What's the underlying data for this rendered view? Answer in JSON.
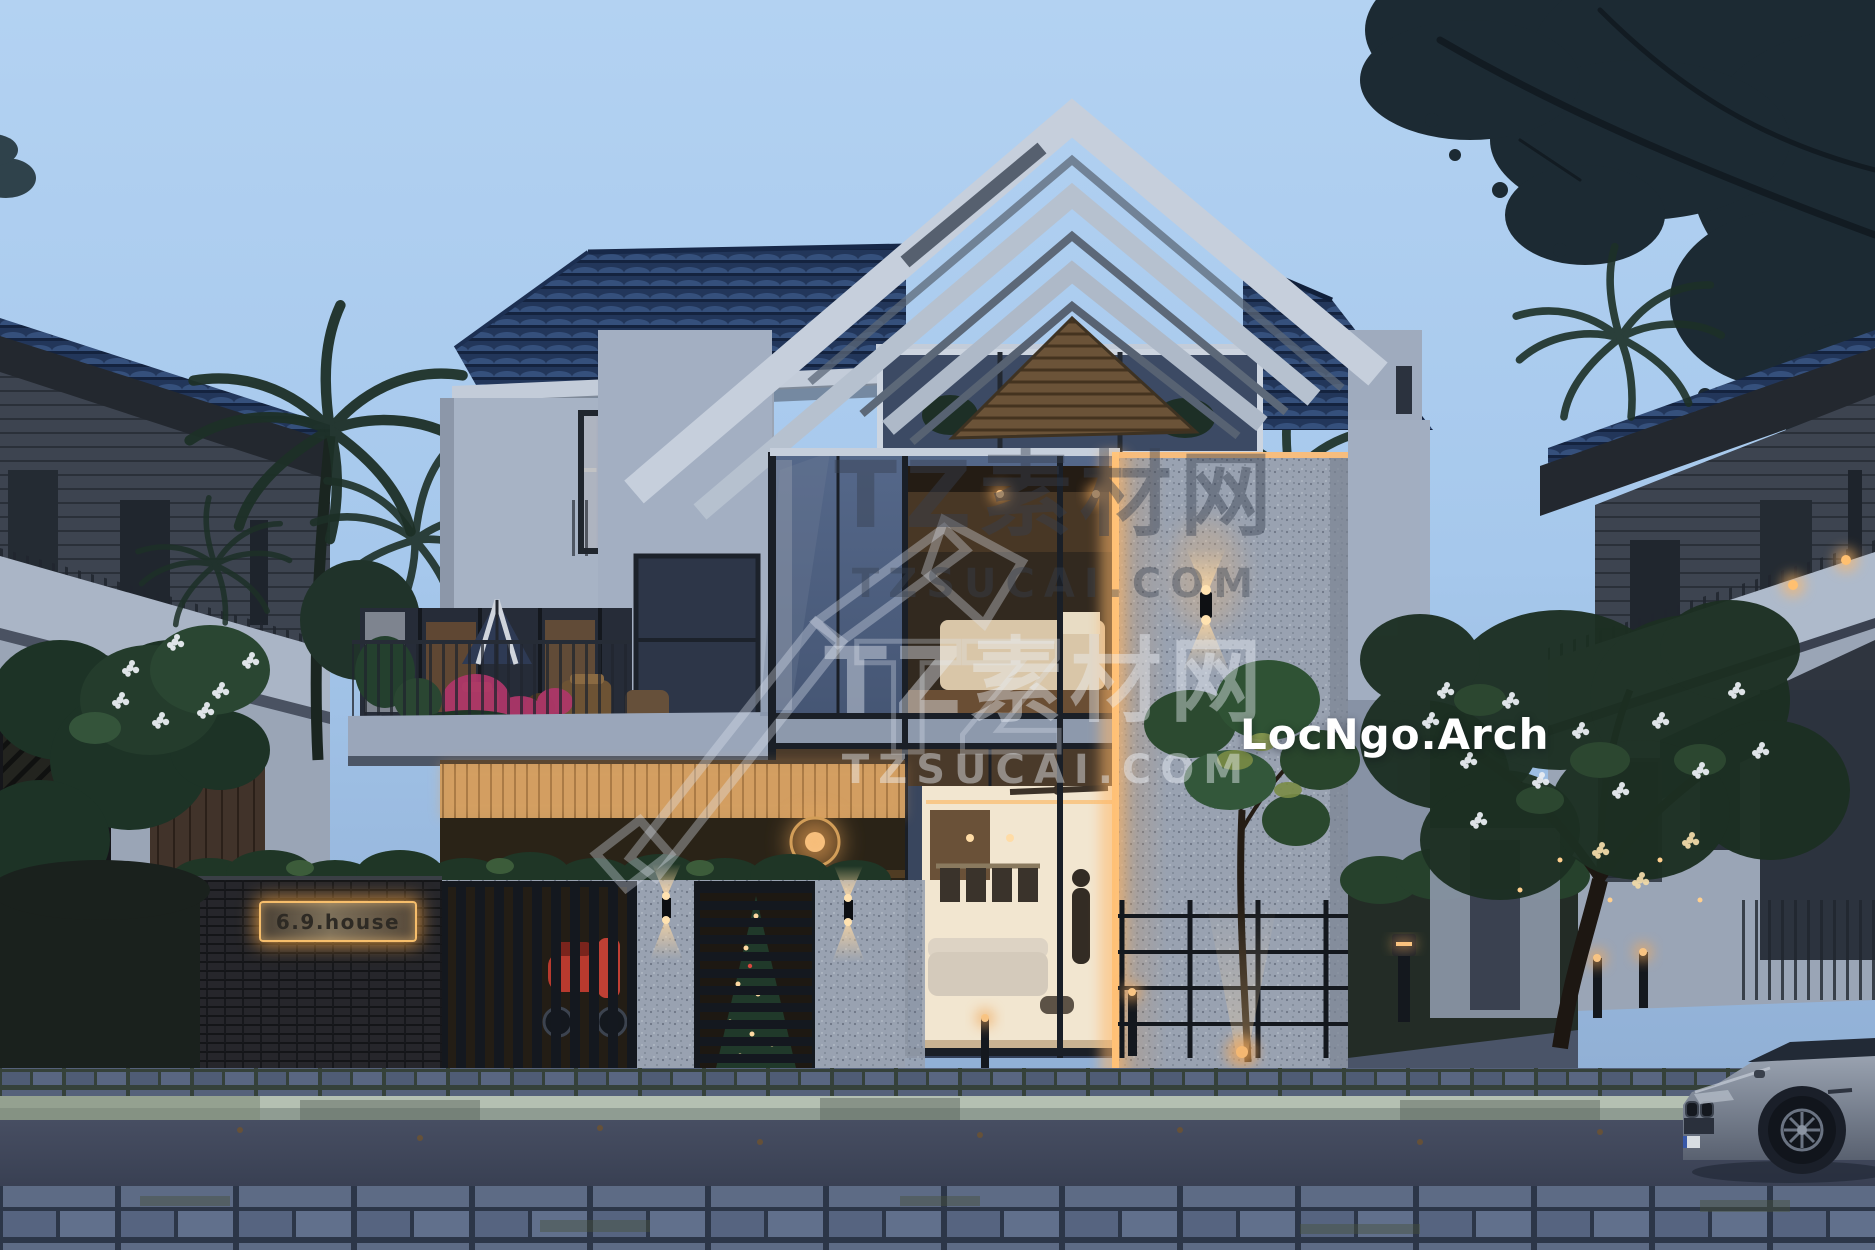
{
  "scene": {
    "description": "Dusk architectural exterior render of modern 3-storey villa 6.9 house",
    "sign_label": "6.9.house",
    "brand": "LocNgo.Arch"
  },
  "watermarks": {
    "primary": {
      "title": "TZ素材网",
      "url": "TZSUCAI.COM"
    },
    "secondary": {
      "title": "TZ素材网",
      "url": "TZSUCAI.COM"
    },
    "logo_letters": "TZ"
  },
  "colors": {
    "sky_top": "#b3d2f2",
    "sky_bottom": "#8aa8cc",
    "roof_tiles": "#22365a",
    "white_wall_dusk": "#a7b3c5",
    "terrazzo": "#99a2b1",
    "warm_light": "#ffc87a",
    "sign_glow": "#ffb457",
    "foliage_dark": "#18252d",
    "asphalt": "#3e4558",
    "paver": "#5d6b85",
    "car_body": "#8f98a6",
    "scooter_red": "#b83a2e",
    "bougainvillea_pink": "#b0366a"
  }
}
